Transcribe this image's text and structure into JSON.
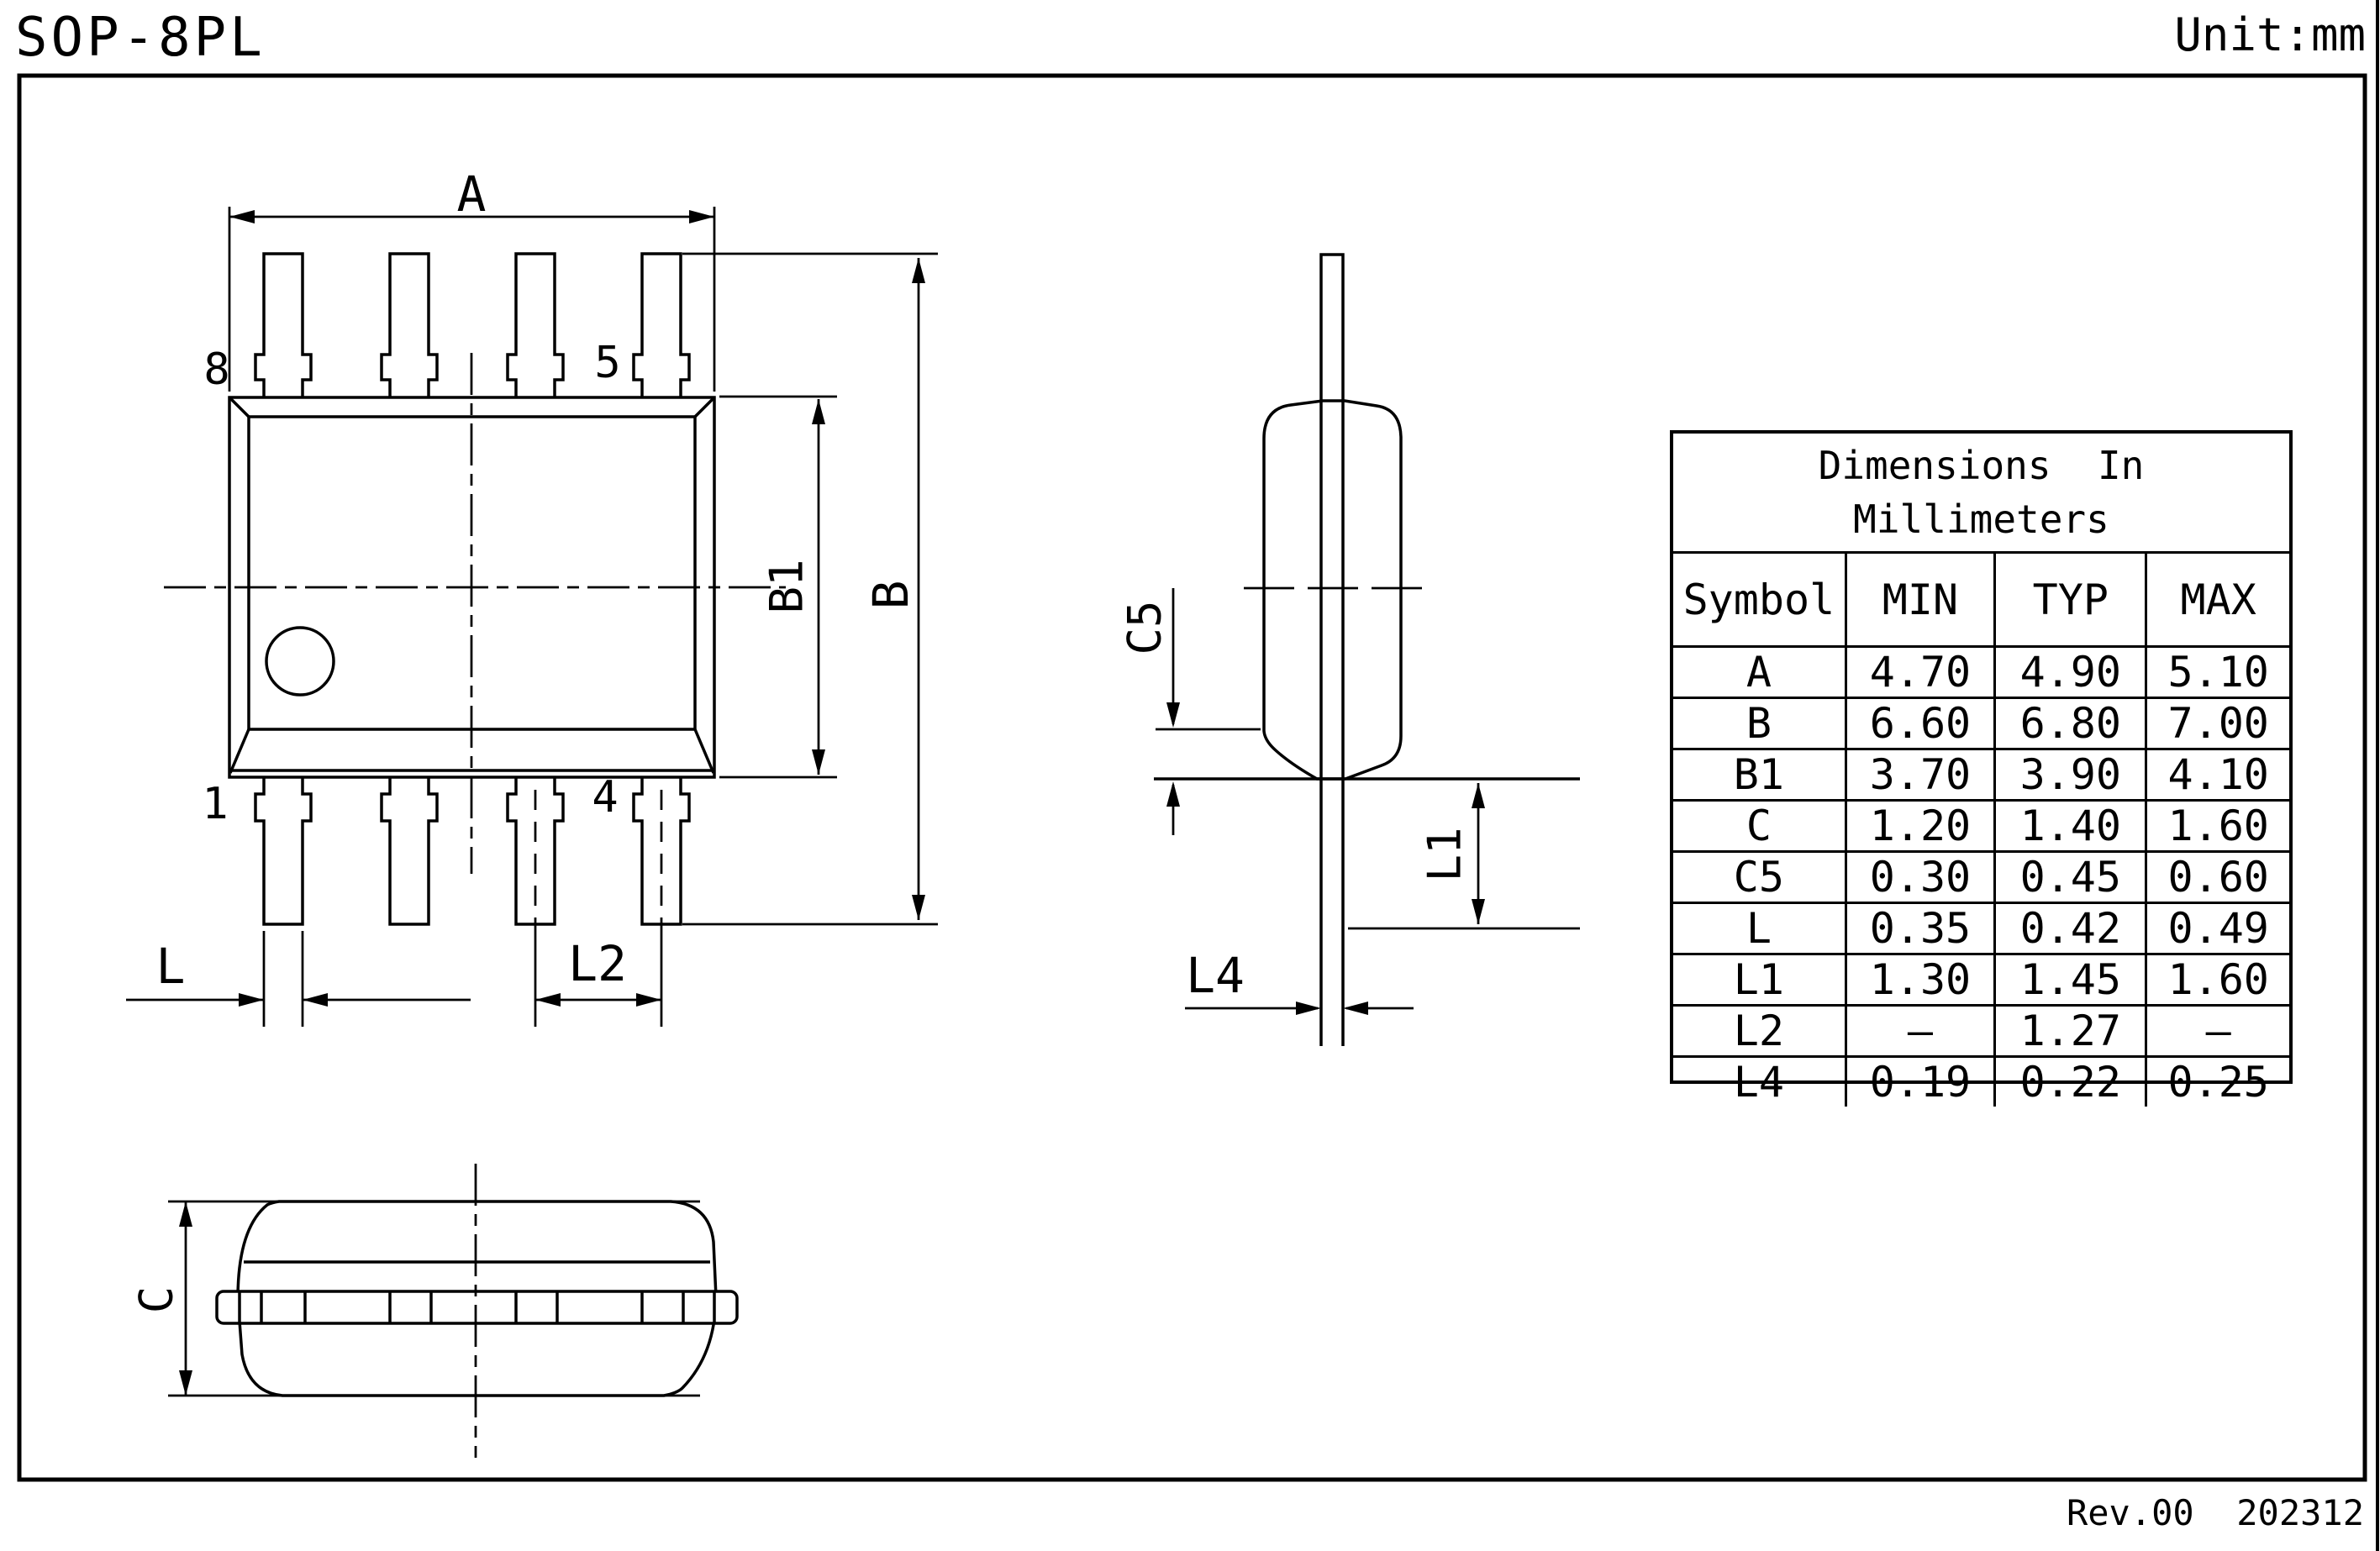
{
  "page": {
    "title": "SOP-8PL",
    "unit": "Unit:mm",
    "revision": "Rev.00  202312"
  },
  "dims": {
    "a": "A",
    "b": "B",
    "b1": "B1",
    "l": "L",
    "l2": "L2",
    "c5": "C5",
    "l1": "L1",
    "l4": "L4",
    "c": "C"
  },
  "pins": {
    "p8": "8",
    "p5": "5",
    "p1": "1",
    "p4": "4"
  },
  "table": {
    "title_line1": "Dimensions  In",
    "title_line2": "Millimeters",
    "headers": [
      "Symbol",
      "MIN",
      "TYP",
      "MAX"
    ],
    "rows": [
      {
        "symbol": "A",
        "min": "4.70",
        "typ": "4.90",
        "max": "5.10"
      },
      {
        "symbol": "B",
        "min": "6.60",
        "typ": "6.80",
        "max": "7.00"
      },
      {
        "symbol": "B1",
        "min": "3.70",
        "typ": "3.90",
        "max": "4.10"
      },
      {
        "symbol": "C",
        "min": "1.20",
        "typ": "1.40",
        "max": "1.60"
      },
      {
        "symbol": "C5",
        "min": "0.30",
        "typ": "0.45",
        "max": "0.60"
      },
      {
        "symbol": "L",
        "min": "0.35",
        "typ": "0.42",
        "max": "0.49"
      },
      {
        "symbol": "L1",
        "min": "1.30",
        "typ": "1.45",
        "max": "1.60"
      },
      {
        "symbol": "L2",
        "min": "–",
        "typ": "1.27",
        "max": "–"
      },
      {
        "symbol": "L4",
        "min": "0.19",
        "typ": "0.22",
        "max": "0.25"
      }
    ]
  }
}
